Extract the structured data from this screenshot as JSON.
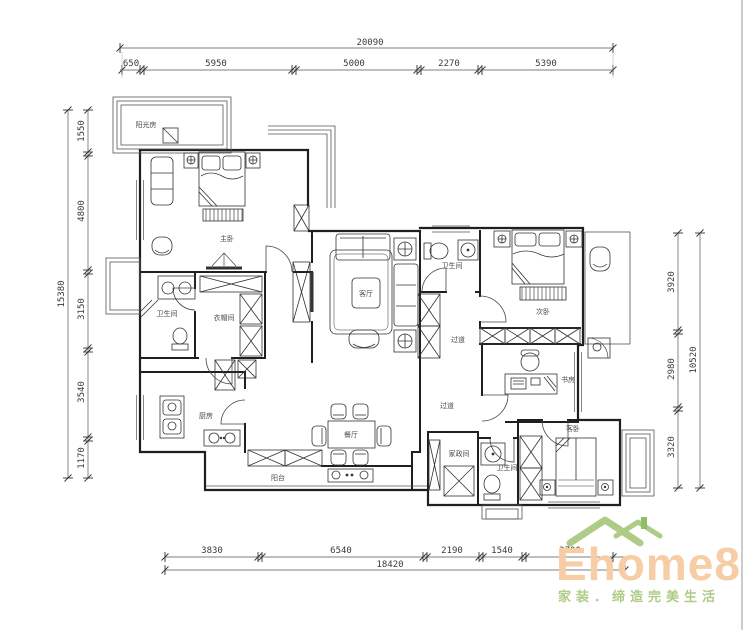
{
  "drawing": {
    "dimensions": {
      "top": {
        "total": "20090",
        "segments": [
          "650",
          "5950",
          "5000",
          "2270",
          "5390"
        ]
      },
      "left": {
        "total": "15380",
        "segments": [
          "1550",
          "4800",
          "3150",
          "3540",
          "1170"
        ]
      },
      "right": {
        "total": "10520",
        "segments": [
          "3920",
          "2980",
          "3320"
        ]
      },
      "bottom": {
        "total": "18420",
        "segments": [
          "3830",
          "6540",
          "2190",
          "1540",
          "3700"
        ]
      }
    },
    "rooms": {
      "sunroom": "阳光房",
      "master_bedroom": "主卧",
      "master_bath": "卫生间",
      "closet": "衣帽间",
      "kitchen": "厨房",
      "balcony": "阳台",
      "dining": "餐厅",
      "living": "客厅",
      "bath2": "卫生间",
      "bedroom2": "次卧",
      "study": "书房",
      "hall_north": "过道",
      "hall_south": "过道",
      "laundry": "家政间",
      "bath3": "卫生间",
      "guest_bedroom": "客卧"
    }
  },
  "logo": {
    "brand": "Ehome8",
    "slogan": "家装．缔造完美生活"
  },
  "colors": {
    "logo_text": "#f6cda4",
    "logo_green": "#aecb87",
    "logo_green_dark": "#8fbd6a",
    "line": "#1f1f1f"
  }
}
